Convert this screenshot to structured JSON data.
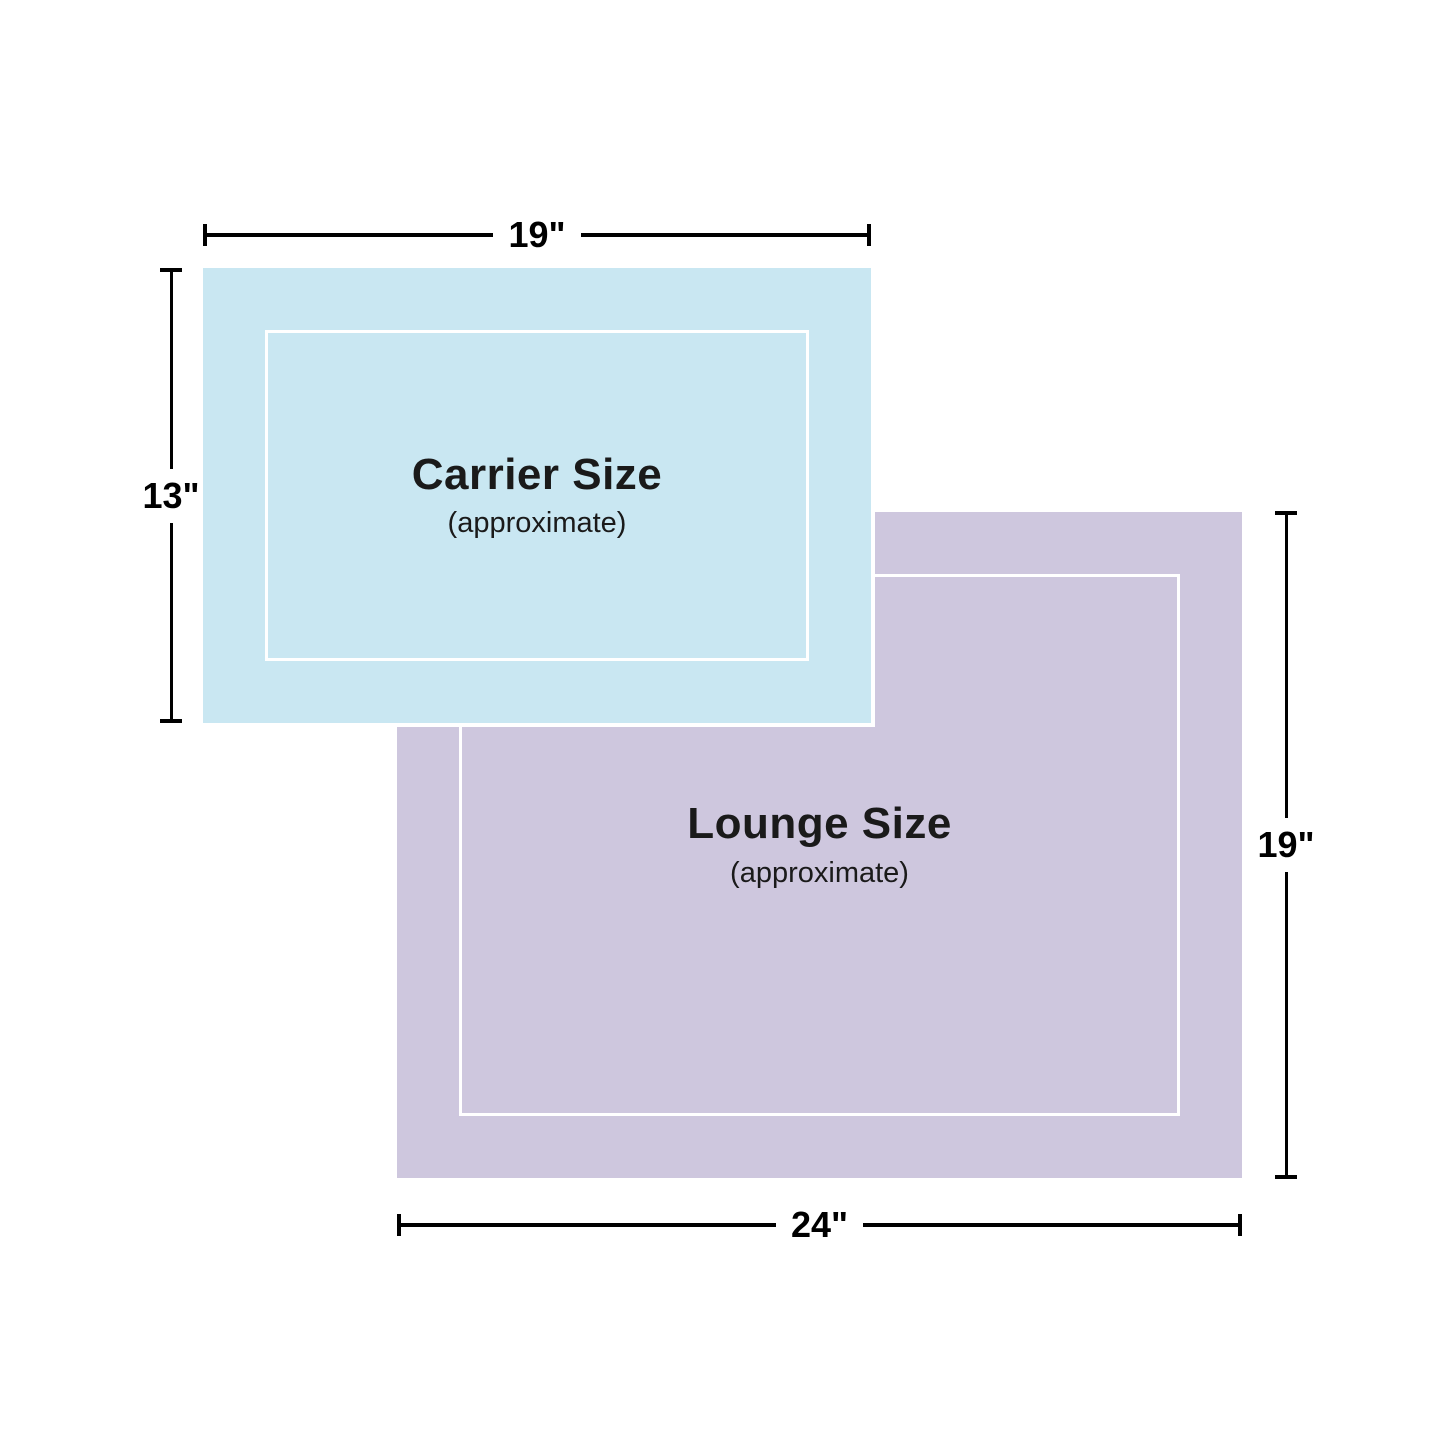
{
  "colors": {
    "background": "#ffffff",
    "carrier-fill": "#c9e7f2",
    "lounge-fill": "#cec7de",
    "inner-border": "#ffffff",
    "dim-line": "#000000",
    "label-text": "#1a1a1a"
  },
  "carrier": {
    "title": "Carrier Size",
    "subtitle": "(approximate)",
    "width_label": "19\"",
    "height_label": "13\""
  },
  "lounge": {
    "title": "Lounge Size",
    "subtitle": "(approximate)",
    "width_label": "24\"",
    "height_label": "19\""
  }
}
